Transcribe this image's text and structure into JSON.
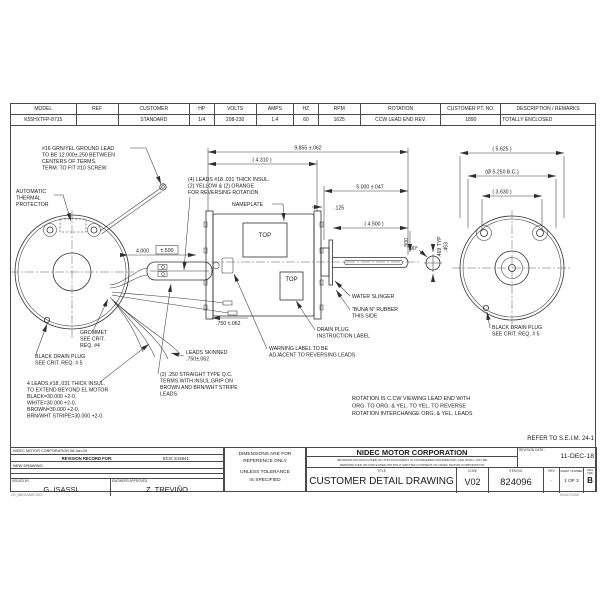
{
  "spec_table": {
    "headers": [
      "MODEL",
      "REF",
      "CUSTOMER",
      "HP",
      "VOLTS",
      "AMPS",
      "HZ",
      "RPM",
      "ROTATION",
      "CUSTOMER PT. NO.",
      "DESCRIPTION / REMARKS"
    ],
    "row": [
      "K55HXTFP-8715",
      "",
      "STANDARD",
      "1/4",
      "208-230",
      "1.4",
      "60",
      "1625",
      "CCW LEAD END REV.",
      "1890",
      "TOTALLY ENCLOSED"
    ]
  },
  "annotations": {
    "ground_lead": [
      "#16 GRN/YEL GROUND LEAD",
      "TO BE 12.000±.250 BETWEEN",
      "CENTERS OF TERMS.",
      "TERM. TO FIT #10 SCREW"
    ],
    "thermal": [
      "AUTOMATIC",
      "THERMAL",
      "PROTECTOR"
    ],
    "reversing_leads": [
      "(4) LEADS #18 .031 THICK INSUL.",
      "(2) YELLOW & (2) ORANGE",
      "FOR REVERSING ROTATION"
    ],
    "nameplate": "NAMEPLATE",
    "top_label_1": "TOP",
    "top_label_2": "TOP",
    "grommet": [
      "GROMMET",
      "SEE CRIT.",
      "REQ. #4"
    ],
    "drain_left": [
      "BLACK DRAIN PLUG",
      "SEE CRIT. REQ. # 5"
    ],
    "four_leads": [
      "4 LEADS,#18,.031 THICK INSUL.",
      "TO EXTEND BEYOND EL MOTOR",
      "BLACK=30.000 +2-0,",
      "WHITE=30.000 +2-0,",
      "BROWN=30.000 +2-0,",
      "BRN/WHT STRIPE=30.000 +2-0."
    ],
    "leads_skinned": [
      "LEADS SKINNED",
      ".750±.062"
    ],
    "qc_terms": [
      "(2) .250 STRAIGHT TYPE Q.C.",
      "TERMS.WITH INSUL.GRIP ON",
      "BROWN AND BRN/WHT STRIPE",
      "LEADS."
    ],
    "water_slinger": "WATER SLINGER",
    "buna": [
      "\"BUNA N\" RUBBER",
      "THIS SIDE"
    ],
    "drain_label": [
      "DRAIN PLUG",
      "INSTRUCTION LABEL"
    ],
    "warning": [
      "WARNING LABEL TO BE",
      "ADJACENT TO REVERSING LEADS"
    ],
    "drain_right": [
      "BLACK DRAIN PLUG",
      "SEE CRIT. REQ. # 5"
    ],
    "rotation_note": [
      "ROTATION IS C.CW VIEWING LEAD END WITH",
      "ORG. TO ORG. & YEL. TO YEL. TO REVERSE",
      "ROTATION INTERCHANGE ORG. & YEL. LEADS"
    ],
    "refer": "REFER TO S.E.I.M. 24-1"
  },
  "dimensions": {
    "overall": "9.855 ±.062",
    "d4310": "( 4.310 )",
    "d5000": "5.000 ±.047",
    "d125": ".125",
    "d4500": "( 4.500 )",
    "d500": ".500",
    "d4000": "4.000",
    "d4000_tol": "±.500",
    "d750": ".750 ±.062",
    "d5625": "( 5.625 )",
    "d5250": "(Ø 5.250 B.C.)",
    "d3630": "( 3.630 )",
    "d469": ".469 TYP",
    "d453": ".453",
    "d90": "90°"
  },
  "title_block": {
    "left": {
      "corp_date": "NIDEC MOTOR CORPORATION 08-Jan-19",
      "revision_record": "REVISION RECORD FOR:",
      "eco": "ECO: E32641",
      "new_drawing": "NEW DRAWING.",
      "issued_by_label": "ISSUED BY:",
      "issued_by": "G. ISASSI",
      "engineer_label": "ENGINEER APPROVED:",
      "engineer": "Z. TREVIÑO",
      "form_code": "CD_NMC8 MAR-2014"
    },
    "dims_note": [
      "DIMENSIONS ARE FOR",
      "REFERENCE ONLY",
      "UNLESS TOLERANCE",
      "IS SPECIFIED"
    ],
    "right": {
      "company": "NIDEC MOTOR CORPORATION",
      "proprietary_1": "INFORMATION DISCLOSED ON THIS DOCUMENT IS CONSIDERED PROPRIETARY AND SHALL NOT BE",
      "proprietary_2": "REPRODUCED OR DISCLOSED WITHOUT WRITTEN CONSENT OF NIDEC MOTOR CORPORATION",
      "title_label": "TITLE",
      "title": "CUSTOMER  DETAIL  DRAWING",
      "code_label": "CODE",
      "code": "V02",
      "item_label": "ITEM NO.",
      "item": "824096",
      "rev_label": "REV",
      "rev": "-",
      "sheet_label": "SHEET NUMBER",
      "sheet": "1  OF  3",
      "size_label": "DWG SIZE",
      "size": "B",
      "revision_date_label": "REVISION DATE :",
      "revision_date": "11-DEC-18",
      "cad": "SOLID EDGE"
    }
  }
}
